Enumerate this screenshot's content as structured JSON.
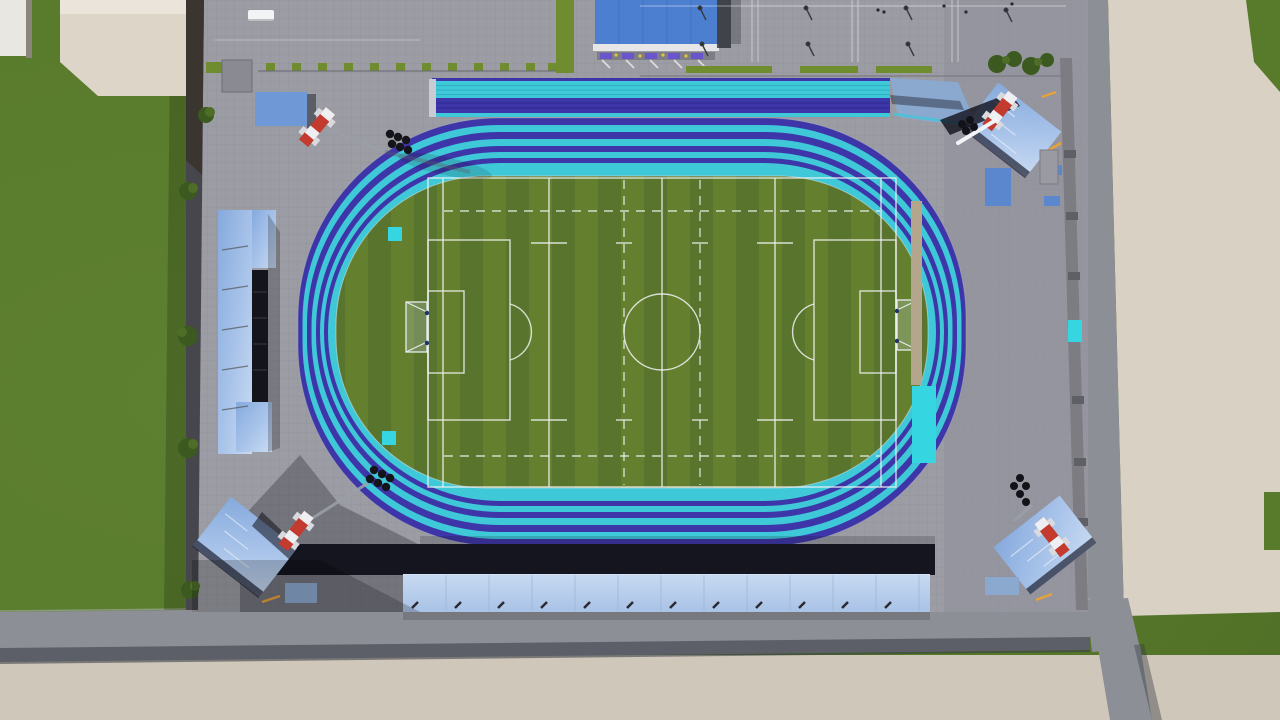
{
  "scene": {
    "type": "3d-architectural-render",
    "view": "aerial-top-down",
    "subject": "Athletics stadium with running track, football field, grandstands, parking lot and perimeter roads",
    "features": [
      "Running track of alternating cyan and indigo lane bands around a green field",
      "Football/rugby field with white solid and dashed markings, center circle, penalty boxes and goals",
      "Separate warm-up sprint straight outside the north curve",
      "Four floodlight towers with red-and-white masts at the corners",
      "Blue-roofed grandstands on west, south and three tilted corner stands",
      "Large blue-roofed entrance building at the north with white fascia and flower boxes",
      "Parking lot with light poles, white bay lines and hedges at the north-east",
      "Planter boxes and trees along the west boundary wall",
      "Gray perimeter roads and beige buildings on the outside",
      "Long-jump runway with cyan landing pit inside the east side of the field"
    ]
  },
  "counts": {
    "floodlight_towers": 4,
    "tilted_corner_grandstands": 3,
    "track_color_bands": 8,
    "warmup_straight_lanes": 7,
    "parking_sections": 4,
    "planter_boxes": 12
  },
  "colors": {
    "grass": "#587a2b",
    "grassDark": "#4c6a25",
    "fieldLight": "#64802e",
    "fieldDark": "#59742c",
    "plaza": "#9c9ca4",
    "plazaDark": "#90909a",
    "road": "#8d8f96",
    "roadShadow": "#343944",
    "pavement": "#cfc7b9",
    "buildingBeige": "#d9d1c4",
    "buildingTopLeft": "#ddd5c7",
    "buildingWhite": "#e9e7e2",
    "wallDark": "#46464c",
    "trackCyan": "#3fc8d8",
    "trackIndigo": "#3d35a8",
    "cyanBright": "#35d6e2",
    "runwayTan": "#b3a68d",
    "roofBlue": "#4d7fd0",
    "roofSeam": "#3f6fc0",
    "canopyBlue": "#6f98d6",
    "benchBlue": "#5b87cf",
    "rampBlue": "#8ba8cf",
    "fasciaWhite": "#e6e6e6",
    "standDark": "#15151f",
    "mastRed": "#c23b2e",
    "mastWhite": "#edeff3",
    "clusterDark": "#121218",
    "treeDark": "#3c5a20",
    "treeLight": "#4e6e28",
    "hedge": "#6f8c2e",
    "accentOrange": "#e8a23c",
    "lineWhite": "#eef2f2"
  }
}
